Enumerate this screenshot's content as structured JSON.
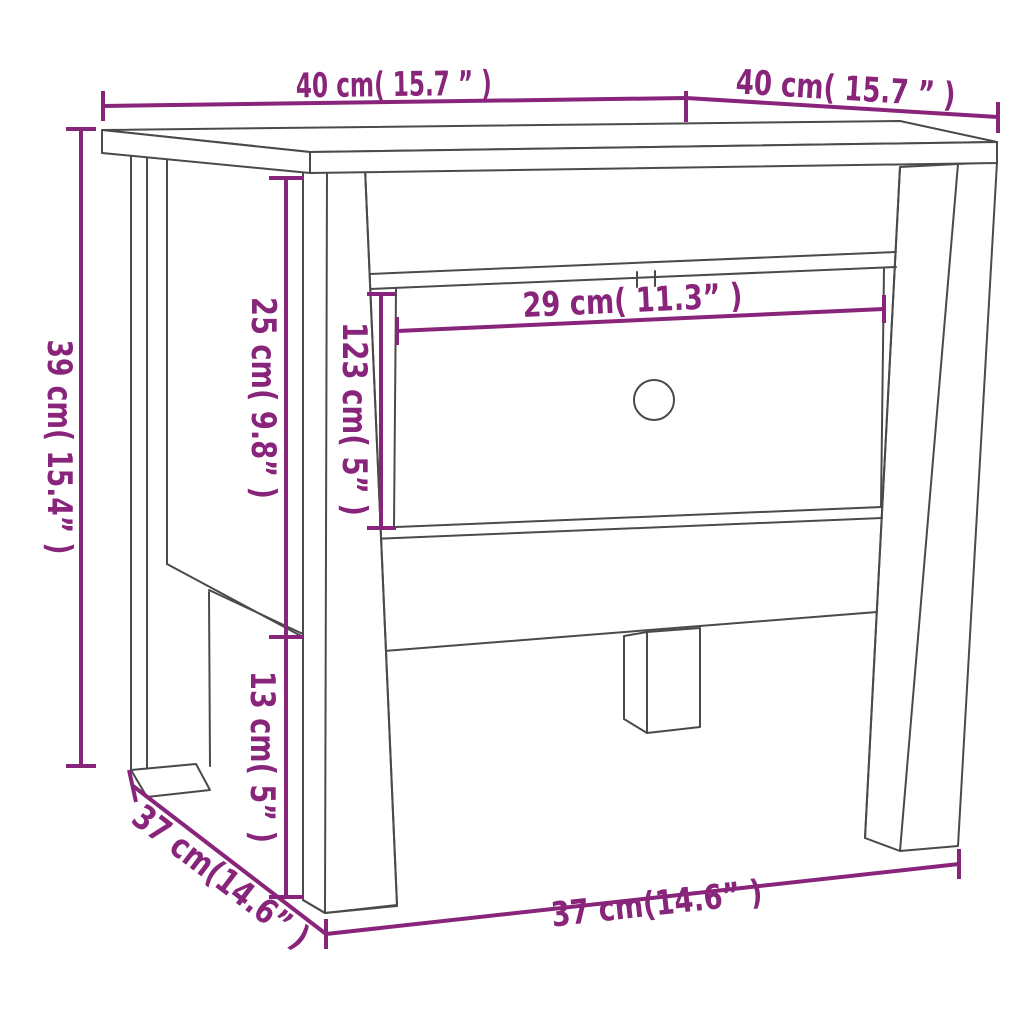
{
  "diagram": {
    "type": "furniture-dimension-diagram",
    "background_color": "#ffffff",
    "outline_color": "#4a4a4a",
    "dimension_color": "#88247a",
    "labels": {
      "top_width": "40 cm( 15.7 ” )",
      "top_depth": "40 cm( 15.7 ” )",
      "total_height": "39 cm( 15.4” )",
      "apron_section_height": "25 cm( 9.8” )",
      "drawer_front_height": "123 cm( 5” )",
      "leg_clearance_height": "13 cm( 5” )",
      "drawer_width": "29 cm( 11.3” )",
      "base_depth": "37 cm(14.6” )",
      "base_width": "37 cm(14.6” )"
    }
  }
}
